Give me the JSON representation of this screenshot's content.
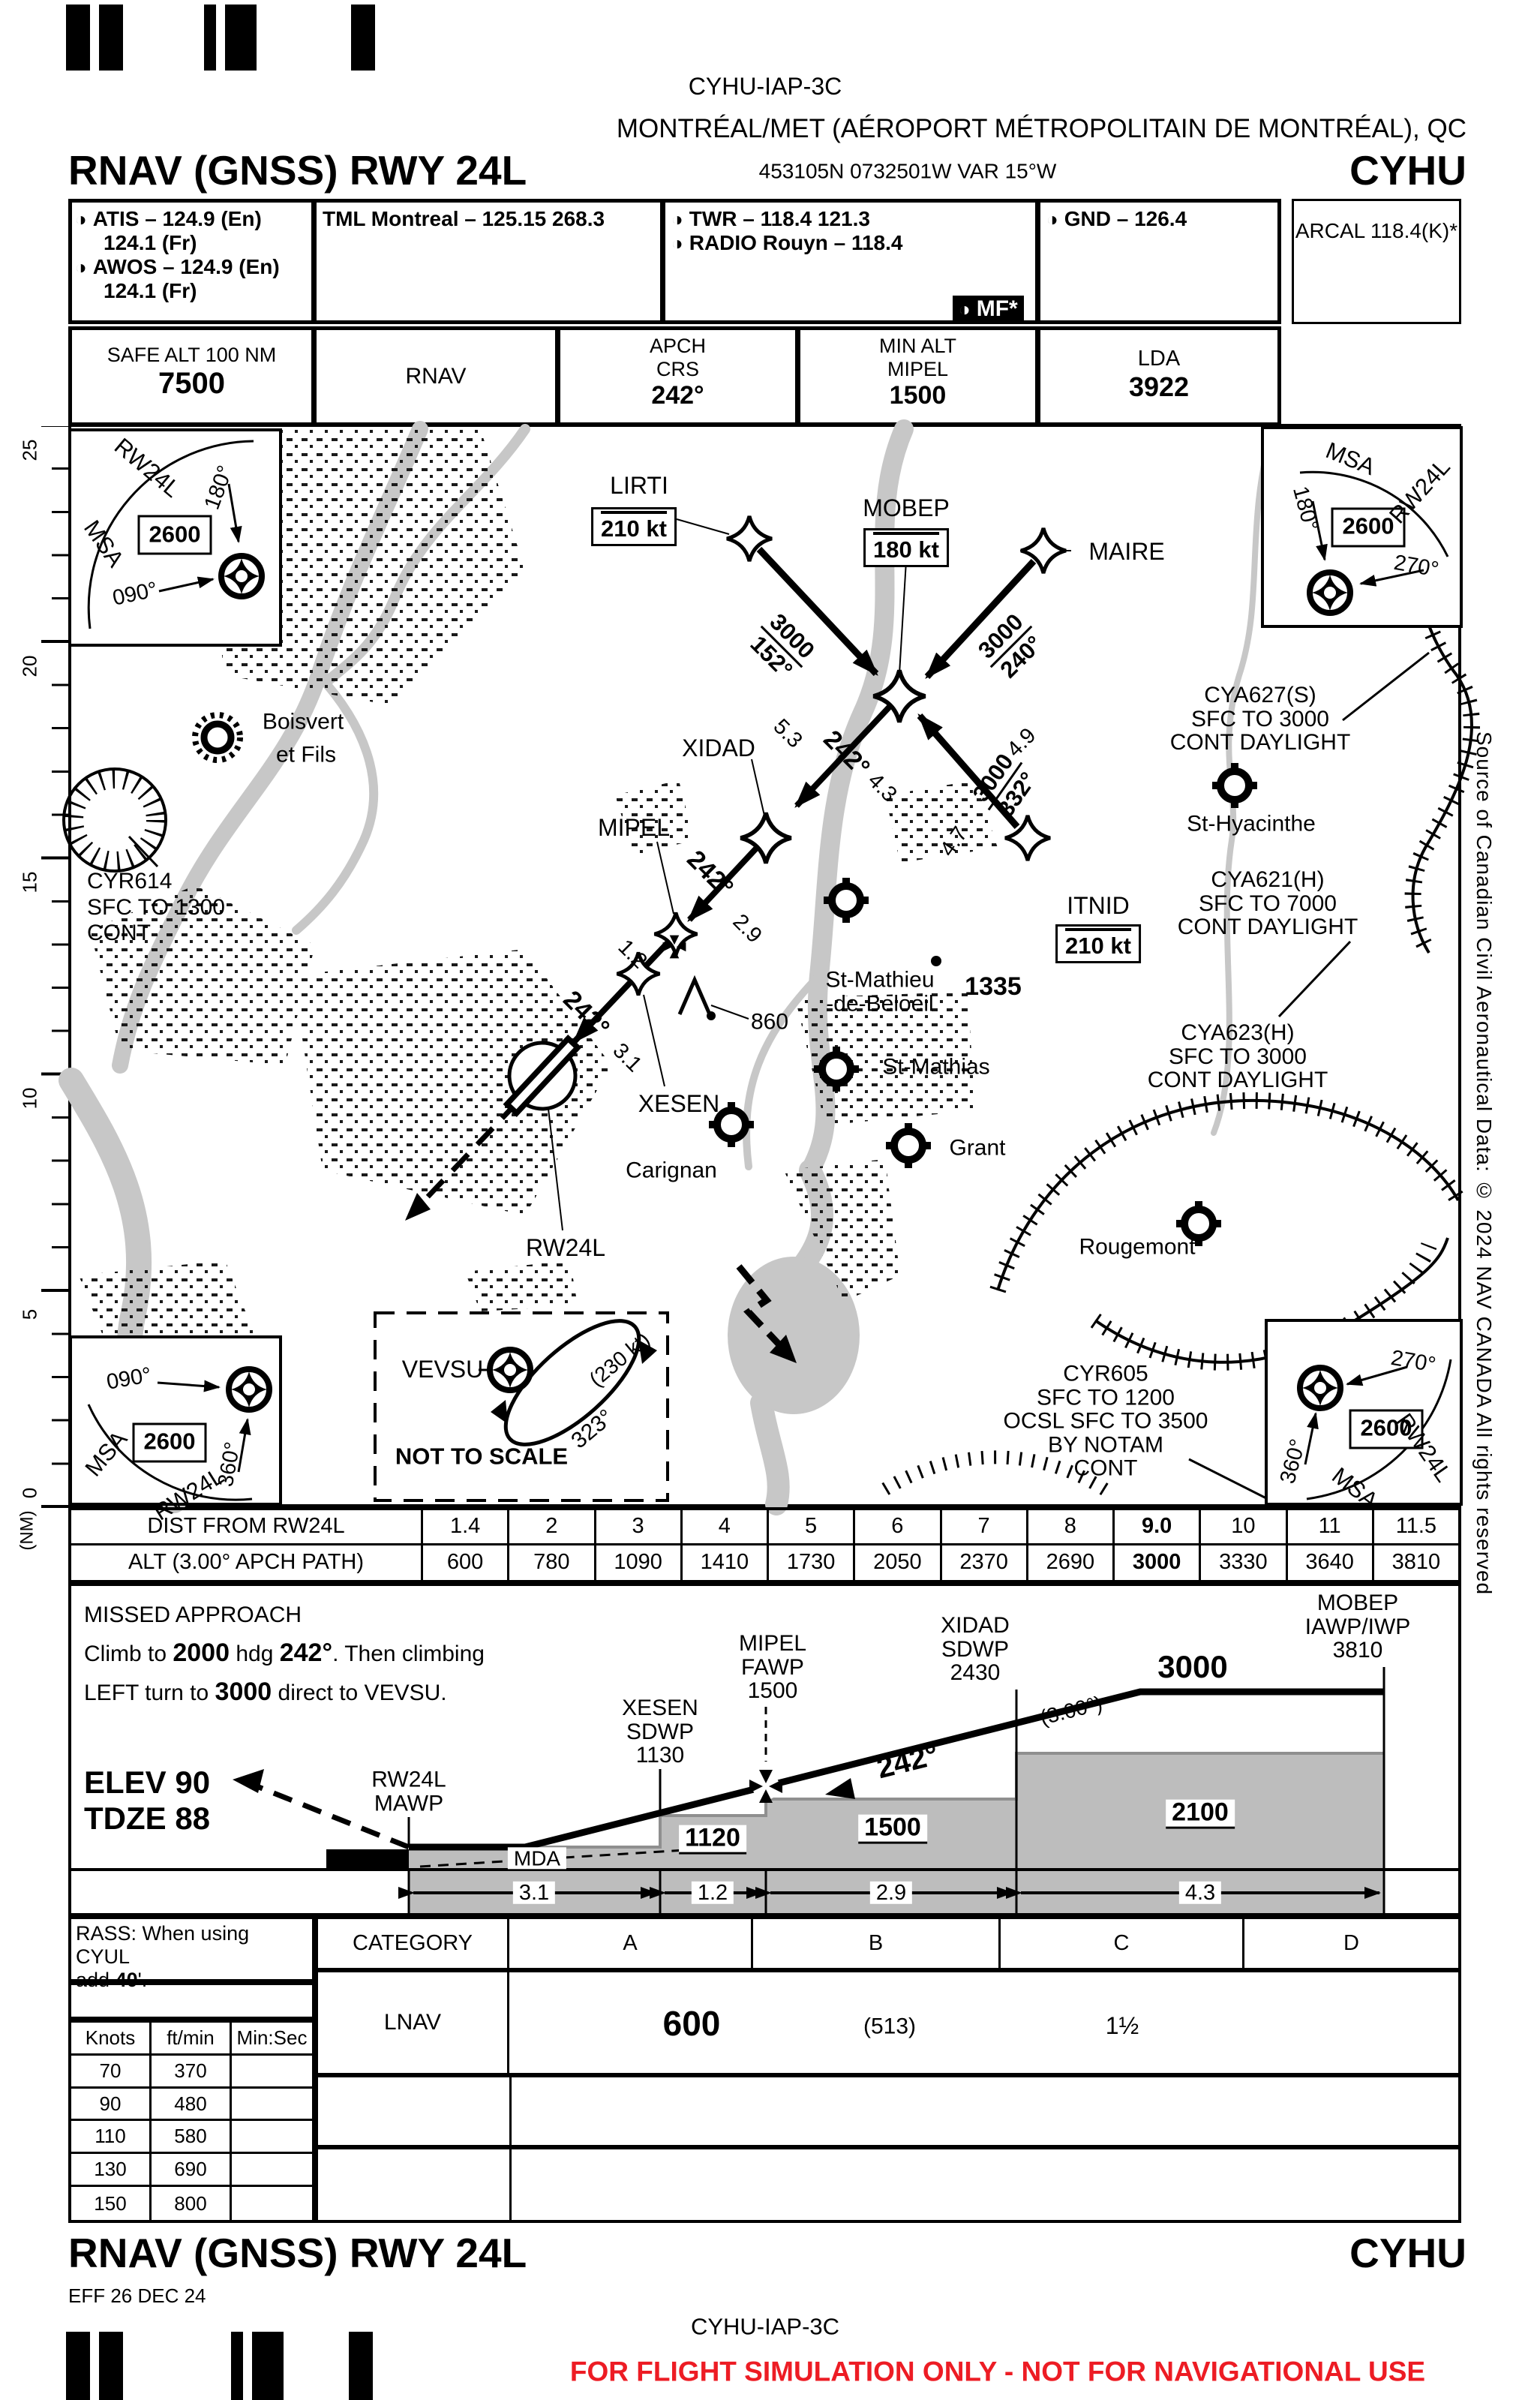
{
  "doc": {
    "plate_id": "CYHU-IAP-3C",
    "city": "MONTRÉAL/MET (AÉROPORT MÉTROPOLITAIN DE MONTRÉAL), QC",
    "title": "RNAV (GNSS) RWY 24L",
    "coords": "453105N  0732501W  VAR 15°W",
    "icao": "CYHU",
    "eff": "EFF 26 DEC 24",
    "copyright": "Source of Canadian Civil Aeronautical Data: © 2024 NAV CANADA All rights reserved",
    "disclaimer": "FOR FLIGHT SIMULATION ONLY - NOT FOR NAVIGATIONAL USE",
    "red": "#ed1c24"
  },
  "comms": {
    "atis1": "ATIS – 124.9 (En)",
    "atis2": "124.1 (Fr)",
    "awos1": "AWOS – 124.9 (En)",
    "awos2": "124.1 (Fr)",
    "tml": "TML Montreal – 125.15  268.3",
    "twr": "TWR – 118.4  121.3",
    "radio": "RADIO Rouyn – 118.4",
    "mf": "MF*",
    "gnd": "GND – 126.4",
    "arcal": "ARCAL 118.4(K)*"
  },
  "databar": {
    "safe_label": "SAFE ALT 100 NM",
    "safe": "7500",
    "nav": "RNAV",
    "apch1": "APCH",
    "apch2": "CRS",
    "apch3": "242°",
    "min1": "MIN ALT",
    "min2": "MIPEL",
    "min3": "1500",
    "lda1": "LDA",
    "lda2": "3922"
  },
  "msa": {
    "tl": {
      "t1": "MSA",
      "t2": "RW24L",
      "alt": "2600",
      "a": "180°",
      "b": "090°"
    },
    "tr": {
      "t1": "MSA",
      "t2": "RW24L",
      "alt": "2600",
      "a": "180°",
      "b": "270°"
    },
    "bl": {
      "t1": "MSA",
      "t2": "RW24L",
      "alt": "2600",
      "a": "090°",
      "b": "360°"
    },
    "br": {
      "t1": "MSA",
      "t2": "RW24L",
      "alt": "2600",
      "a": "270°",
      "b": "360°"
    }
  },
  "scale": {
    "t25": "25",
    "t20": "20",
    "t15": "15",
    "t10": "10",
    "t5": "5",
    "t0": "0",
    "unit": "(NM)"
  },
  "map": {
    "lirti": "LIRTI",
    "lirti_spd": "210 kt",
    "mobep": "MOBEP",
    "mobep_spd": "180 kt",
    "maire": "MAIRE",
    "xidad": "XIDAD",
    "mipel": "MIPEL",
    "xesen": "XESEN",
    "itnid": "ITNID",
    "itnid_spd": "210 kt",
    "rw24l": "RW24L",
    "vevsu": "VEVSU",
    "hold_spd": "(230 kt)",
    "hold_crs": "323°",
    "nts": "NOT TO SCALE",
    "trk1_alt": "3000",
    "trk1_crs": "152°",
    "trk1_dist": "5.3",
    "trk2_alt": "3000",
    "trk2_crs": "240°",
    "trk2_dist": "4.9",
    "trk3_alt": "3000",
    "trk3_crs": "332°",
    "trk3_dist": "4.7",
    "fin1_crs": "242°",
    "fin1_dist": "4.3",
    "fin2_crs": "242°",
    "fin2_dist": "2.9",
    "fin3_dist": "1.2",
    "fin4_crs": "242°",
    "fin4_dist": "3.1",
    "boisvert1": "Boisvert",
    "boisvert2": "et Fils",
    "cyr614_1": "CYR614",
    "cyr614_2": "SFC TO 1300",
    "cyr614_3": "CONT",
    "cya627_1": "CYA627(S)",
    "cya627_2": "SFC TO 3000",
    "cya627_3": "CONT DAYLIGHT",
    "sthyacinthe": "St-Hyacinthe",
    "cya621_1": "CYA621(H)",
    "cya621_2": "SFC TO 7000",
    "cya621_3": "CONT DAYLIGHT",
    "cya623_1": "CYA623(H)",
    "cya623_2": "SFC TO 3000",
    "cya623_3": "CONT DAYLIGHT",
    "stmathieu1": "St-Mathieu",
    "stmathieu2": "-de-Beloeil",
    "stmathias": "St-Mathias",
    "carignan": "Carignan",
    "grant": "Grant",
    "rougemont": "Rougemont",
    "cyr605_1": "CYR605",
    "cyr605_2": "SFC TO 1200",
    "cyr605_3": "OCSL SFC TO 3500",
    "cyr605_4": "BY NOTAM",
    "cyr605_5": "CONT",
    "obst860": "860",
    "spot1335": "1335"
  },
  "dist_table": {
    "row1_label": "DIST FROM RW24L",
    "row2_label": "ALT (3.00° APCH PATH)",
    "dist": [
      "1.4",
      "2",
      "3",
      "4",
      "5",
      "6",
      "7",
      "8",
      "9.0",
      "10",
      "11",
      "11.5"
    ],
    "alt": [
      "600",
      "780",
      "1090",
      "1410",
      "1730",
      "2050",
      "2370",
      "2690",
      "3000",
      "3330",
      "3640",
      "3810"
    ]
  },
  "profile": {
    "ma1": "MISSED APPROACH",
    "ma2a": "Climb to ",
    "ma2b": "2000",
    "ma2c": " hdg ",
    "ma2d": "242°",
    "ma2e": ".  Then climbing",
    "ma3a": "LEFT turn to ",
    "ma3b": "3000",
    "ma3c": "  direct to VEVSU.",
    "elev": "ELEV  90",
    "tdze": "TDZE  88",
    "mawp1": "RW24L",
    "mawp2": "MAWP",
    "xesen1": "XESEN",
    "xesen2": "SDWP",
    "xesen3": "1130",
    "mipel1": "MIPEL",
    "mipel2": "FAWP",
    "mipel3": "1500",
    "xidad1": "XIDAD",
    "xidad2": "SDWP",
    "xidad3": "2430",
    "mobep1": "MOBEP",
    "mobep2": "IAWP/IWP",
    "mobep3": "3810",
    "gp_angle": "(3.00°)",
    "gp_crs": "242°",
    "level": "3000",
    "mda": "MDA",
    "alt1120": "1120",
    "alt1500": "1500",
    "alt2100": "2100",
    "d1": "3.1",
    "d2": "1.2",
    "d3": "2.9",
    "d4": "4.3"
  },
  "minima": {
    "rass1": "RASS: When using CYUL",
    "rass2a": "add ",
    "rass2b": "40",
    "rass2c": "'.",
    "category": "CATEGORY",
    "catA": "A",
    "catB": "B",
    "catC": "C",
    "catD": "D",
    "lnav": "LNAV",
    "mda": "600",
    "hat": "(513)",
    "vis": "1½",
    "knots": "Knots",
    "ftmin": "ft/min",
    "minsec": "Min:Sec",
    "r1k": "70",
    "r1f": "370",
    "r2k": "90",
    "r2f": "480",
    "r3k": "110",
    "r3f": "580",
    "r4k": "130",
    "r4f": "690",
    "r5k": "150",
    "r5f": "800"
  }
}
